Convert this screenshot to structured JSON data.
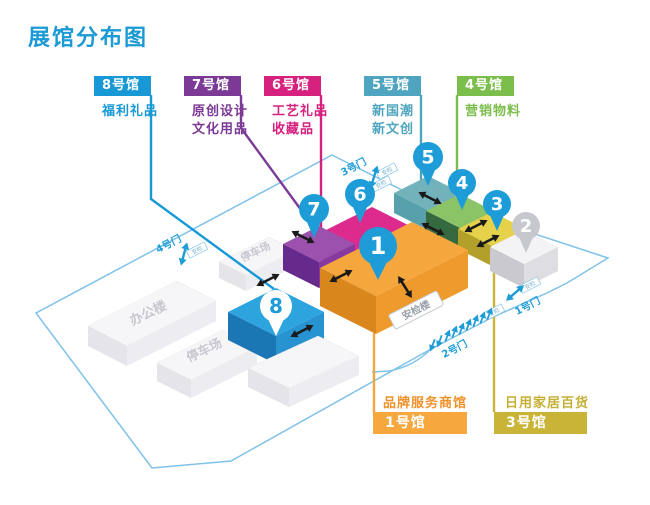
{
  "title": "展馆分布图",
  "colors": {
    "accent": "#1B9AD5",
    "hall8": "#1899D6",
    "hall7": "#7C3A96",
    "hall6": "#D6217F",
    "hall5": "#4FA5BF",
    "hall4": "#7CBE4C",
    "hall1": "#F6A73E",
    "hall3": "#C9B438",
    "pin": "#1E9CD8",
    "pin_gray": "#C7C8CD",
    "boundary": "#7FC2E8"
  },
  "halls_top": [
    {
      "label": "8号馆",
      "desc1": "福利礼品",
      "desc2": ""
    },
    {
      "label": "7号馆",
      "desc1": "原创设计",
      "desc2": "文化用品"
    },
    {
      "label": "6号馆",
      "desc1": "工艺礼品",
      "desc2": "收藏品"
    },
    {
      "label": "5号馆",
      "desc1": "新国潮",
      "desc2": "新文创"
    },
    {
      "label": "4号馆",
      "desc1": "营销物料",
      "desc2": ""
    }
  ],
  "halls_bottom": [
    {
      "category": "品牌服务商馆",
      "label": "1号馆"
    },
    {
      "category": "日用家居百货",
      "label": "3号馆"
    }
  ],
  "map": {
    "pins": {
      "p1": "1",
      "p2": "2",
      "p3": "3",
      "p4": "4",
      "p5": "5",
      "p6": "6",
      "p7": "7",
      "p8": "8"
    },
    "gates": {
      "g1": "1号门",
      "g2": "2号门",
      "g3": "3号门",
      "g4": "4号门"
    },
    "office": "办公楼",
    "parking": "停车场",
    "security_building": "安检楼",
    "checkpoint": "安检"
  }
}
